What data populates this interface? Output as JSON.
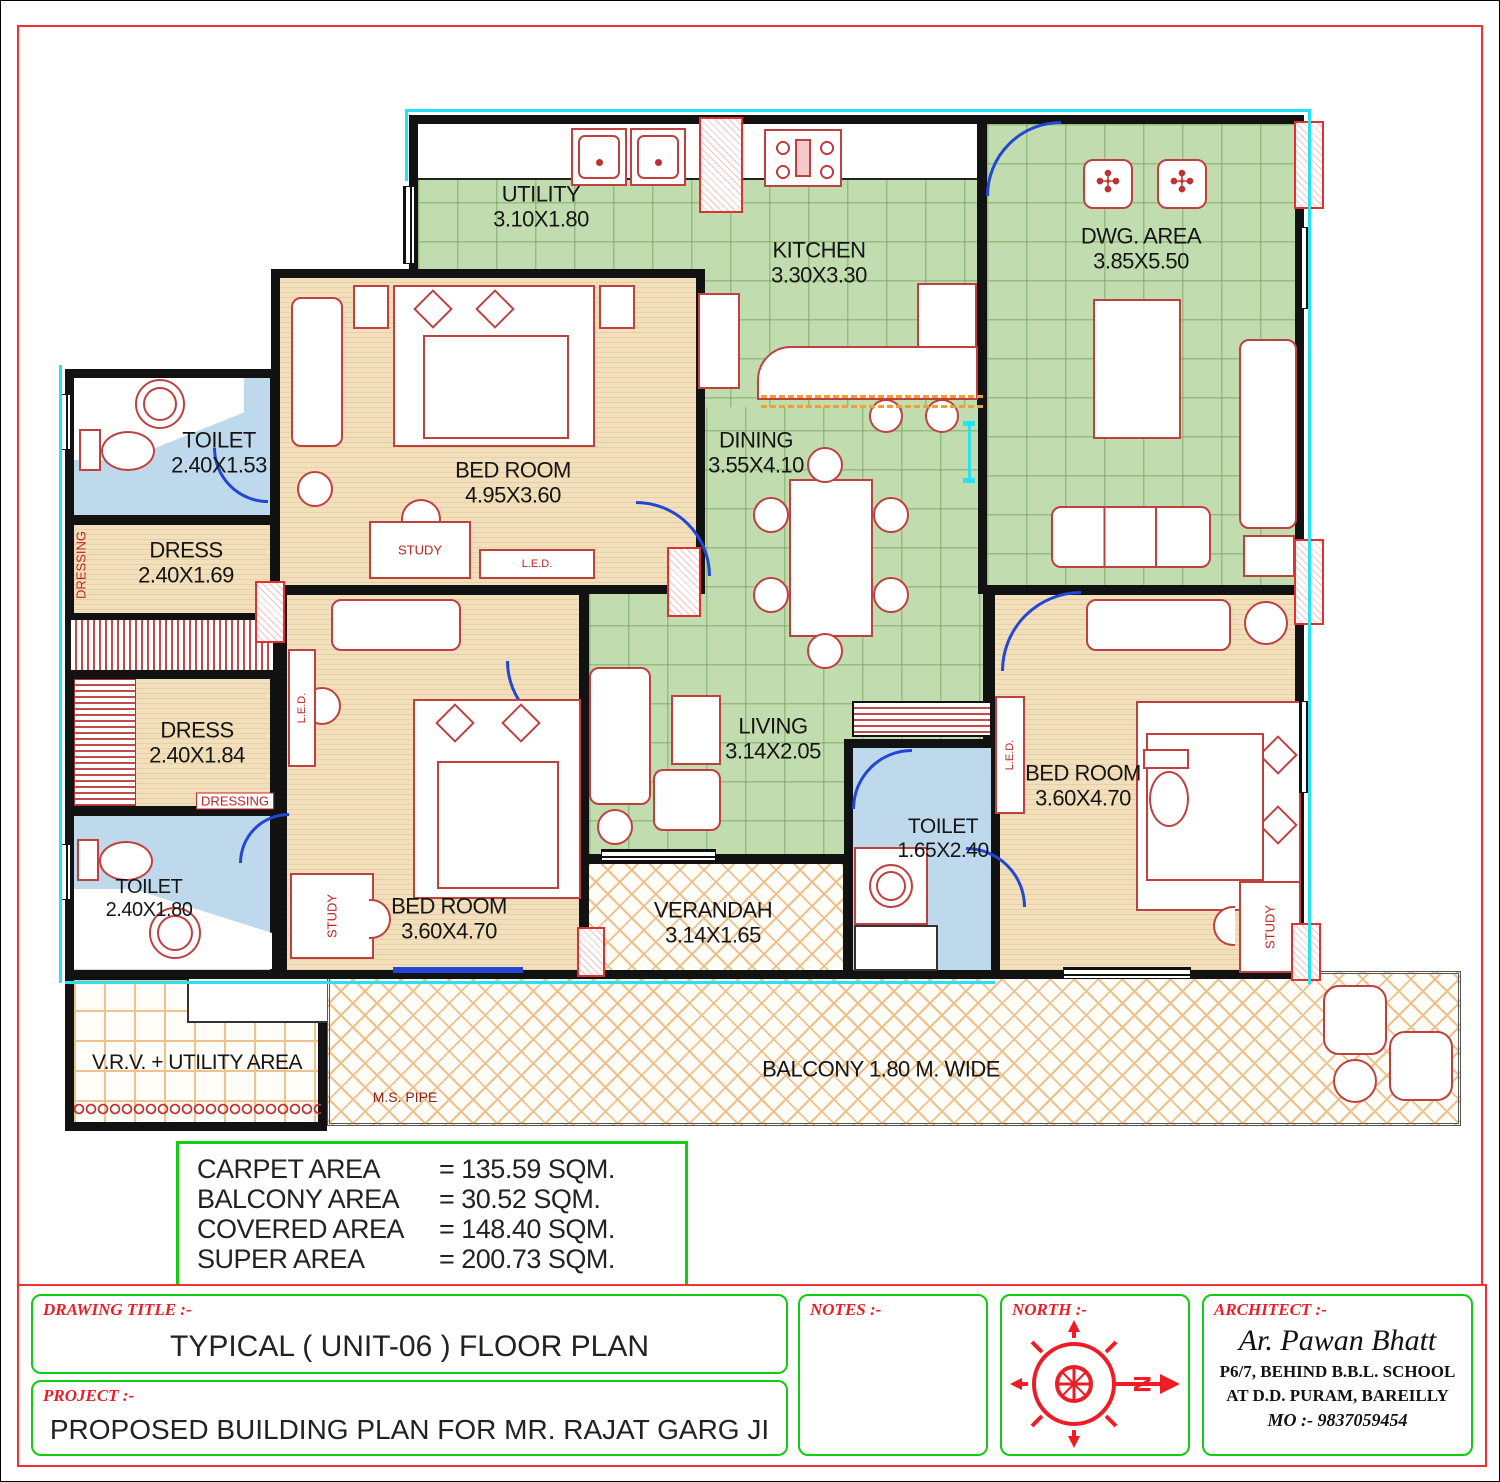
{
  "rooms": {
    "utility": {
      "name": "UTILITY",
      "dim": "3.10X1.80"
    },
    "kitchen": {
      "name": "KITCHEN",
      "dim": "3.30X3.30"
    },
    "dwg": {
      "name": "DWG. AREA",
      "dim": "3.85X5.50"
    },
    "dining": {
      "name": "DINING",
      "dim": "3.55X4.10"
    },
    "living": {
      "name": "LIVING",
      "dim": "3.14X2.05"
    },
    "verandah": {
      "name": "VERANDAH",
      "dim": "3.14X1.65"
    },
    "bed1": {
      "name": "BED ROOM",
      "dim": "4.95X3.60"
    },
    "bed2": {
      "name": "BED ROOM",
      "dim": "3.60X4.70"
    },
    "bed3": {
      "name": "BED ROOM",
      "dim": "3.60X4.70"
    },
    "toilet1": {
      "name": "TOILET",
      "dim": "2.40X1.53"
    },
    "toilet2": {
      "name": "TOILET",
      "dim": "2.40X1.80"
    },
    "toilet3": {
      "name": "TOILET",
      "dim": "1.65X2.40"
    },
    "dress1": {
      "name": "DRESS",
      "dim": "2.40X1.69"
    },
    "dress2": {
      "name": "DRESS",
      "dim": "2.40X1.84"
    },
    "vrv": {
      "name": "V.R.V. + UTILITY AREA"
    },
    "balcony": {
      "name": "BALCONY 1.80 M. WIDE"
    },
    "ms_pipe": "M.S. PIPE"
  },
  "furniture": {
    "study": "STUDY",
    "led": "L.E.D.",
    "dressing": "DRESSING"
  },
  "areas": {
    "rows": [
      {
        "label": "CARPET AREA",
        "value": "= 135.59 SQM."
      },
      {
        "label": "BALCONY AREA",
        "value": "= 30.52 SQM."
      },
      {
        "label": "COVERED AREA",
        "value": "= 148.40 SQM."
      },
      {
        "label": "SUPER AREA",
        "value": "= 200.73 SQM."
      }
    ]
  },
  "title_block": {
    "drawing_title_label": "DRAWING TITLE :-",
    "drawing_title": "TYPICAL ( UNIT-06 ) FLOOR PLAN",
    "project_label": "PROJECT :-",
    "project": "PROPOSED BUILDING PLAN FOR MR. RAJAT GARG JI",
    "notes_label": "NOTES :-",
    "north_label": "NORTH :-",
    "north_letter": "N",
    "architect_label": "ARCHITECT :-",
    "architect_name": "Ar. Pawan Bhatt",
    "architect_addr1": "P6/7,  BEHIND  B.B.L.  SCHOOL",
    "architect_addr2": "AT  D.D.  PURAM,  BAREILLY",
    "architect_mobile": "MO :-  9837059454"
  },
  "colors": {
    "wall": "#121212",
    "floor_green": "#c1dcae",
    "floor_wood": "#f2dfbc",
    "floor_blue": "#bed8ec",
    "frame_red": "#f53030",
    "box_green": "#12cc12",
    "furniture_red": "#c04040",
    "door_blue": "#2247d6",
    "cyan": "#26e3f2",
    "hatch_orange": "#eec08c",
    "label_red": "#ee1c24"
  }
}
